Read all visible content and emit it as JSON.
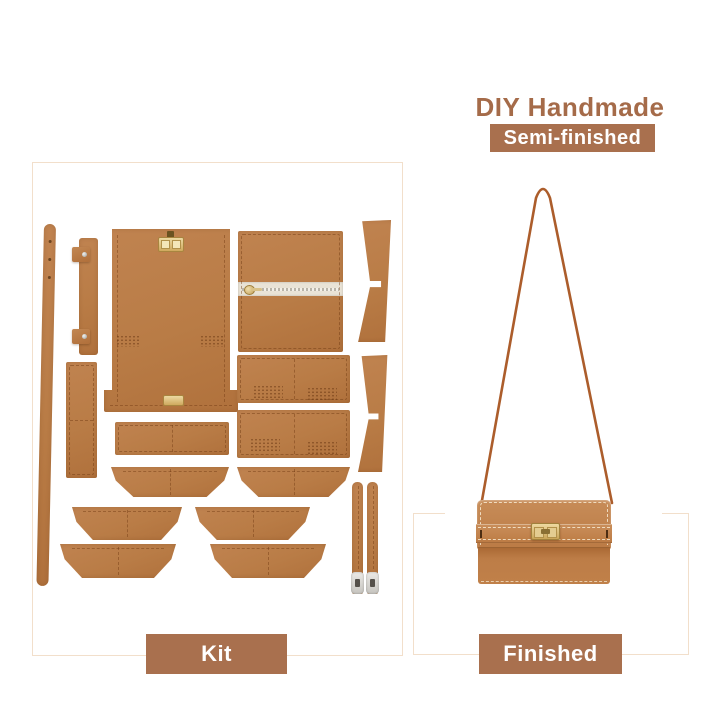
{
  "header": {
    "title": "DIY Handmade",
    "badge": "Semi-finished",
    "title_color": "#a56b49",
    "badge_bg": "#a9704e",
    "badge_text_color": "#ffffff"
  },
  "kit_panel": {
    "label": "Kit",
    "label_bg": "#a9704e",
    "frame_color": "#f2dfcb",
    "leather_color": "#b97c46",
    "hardware_gold": "#d4ac5e",
    "hardware_silver": "#d6d4d0",
    "pieces": [
      "long-shoulder-strap",
      "rivet-tab-strap",
      "small-side-panel",
      "main-body-panel-with-turnlock",
      "zipper-pocket-panel",
      "pocket-panel-upper",
      "pocket-panel-lower",
      "cross-bar-panel",
      "bottom-gusset-left",
      "bottom-gusset-right",
      "side-gusset-top",
      "side-gusset-bottom",
      "flap-trapezoid-mid-left",
      "flap-trapezoid-mid-right",
      "flap-trapezoid-bottom-left",
      "flap-trapezoid-bottom-right",
      "buckle-strap-left",
      "buckle-strap-right"
    ]
  },
  "finished_panel": {
    "label": "Finished",
    "item": "finished tan crossbody bag with gold turn-lock clasp and thin shoulder strap",
    "strap_color": "#ac5d2b",
    "bag_color": "#bd7d47"
  }
}
